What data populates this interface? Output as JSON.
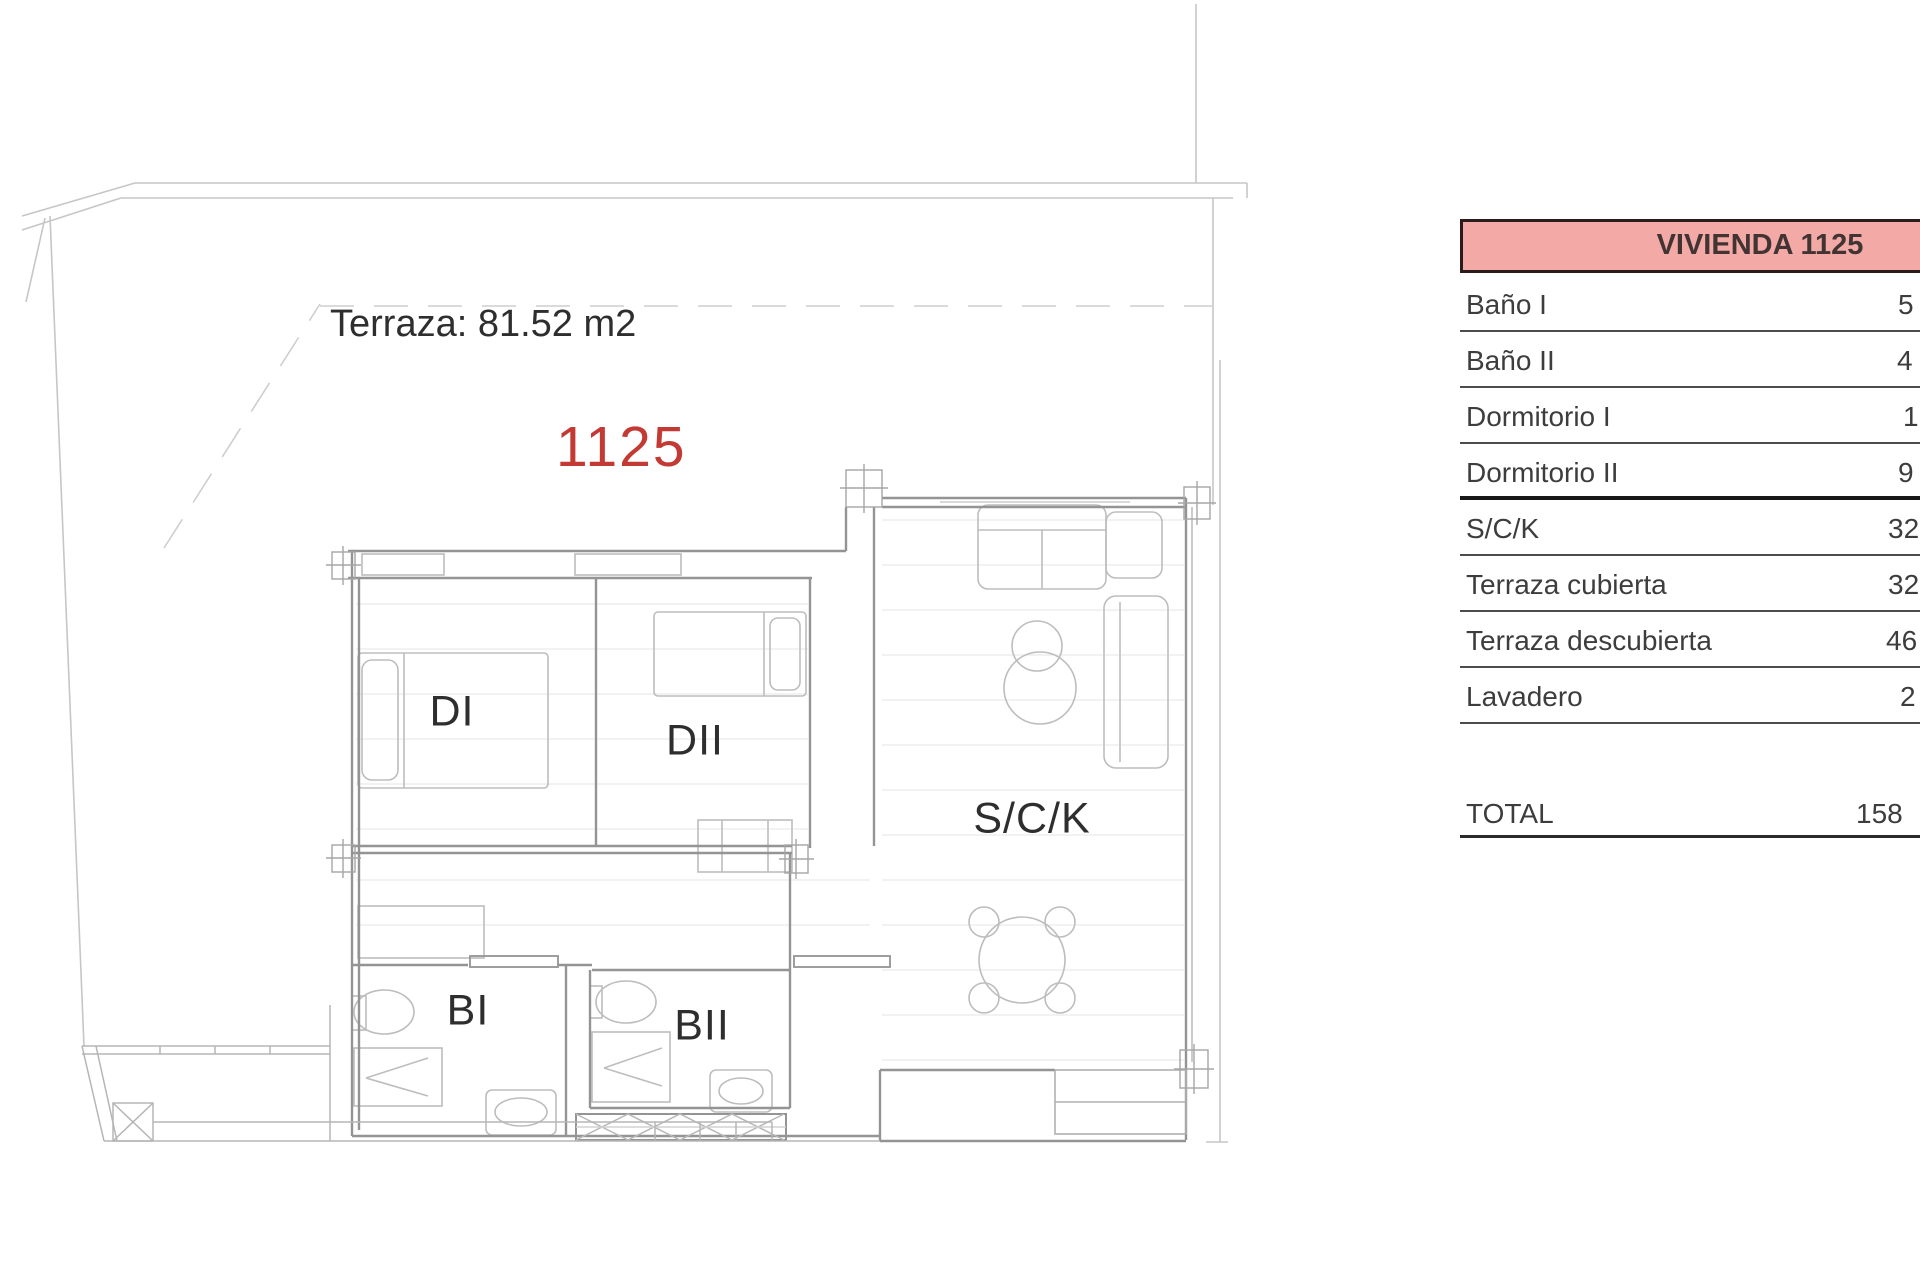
{
  "plan": {
    "terrace_area_label": "Terraza: 81.52 m2",
    "unit_number": "1125",
    "room_labels": {
      "dormitorio_1": "DI",
      "dormitorio_2": "DII",
      "salon_cocina": "S/C/K",
      "bano_1": "BI",
      "bano_2": "BII"
    },
    "colors": {
      "unit_number_red": "#c23a33",
      "wall_gray": "#949494",
      "furniture_gray": "#bdbdbd"
    }
  },
  "area_table": {
    "header": "VIVIENDA 1125",
    "header_bg": "#f3aaa7",
    "rows": [
      {
        "label": "Baño I",
        "value_visible": "5"
      },
      {
        "label": "Baño II",
        "value_visible": "4"
      },
      {
        "label": "Dormitorio I",
        "value_visible": "1"
      },
      {
        "label": "Dormitorio II",
        "value_visible": "9"
      },
      {
        "label": "S/C/K",
        "value_visible": "32"
      },
      {
        "label": "Terraza cubierta",
        "value_visible": "32"
      },
      {
        "label": "Terraza descubierta",
        "value_visible": "46"
      },
      {
        "label": "Lavadero",
        "value_visible": "2"
      }
    ],
    "total": {
      "label": "TOTAL",
      "value_visible": "158"
    }
  }
}
